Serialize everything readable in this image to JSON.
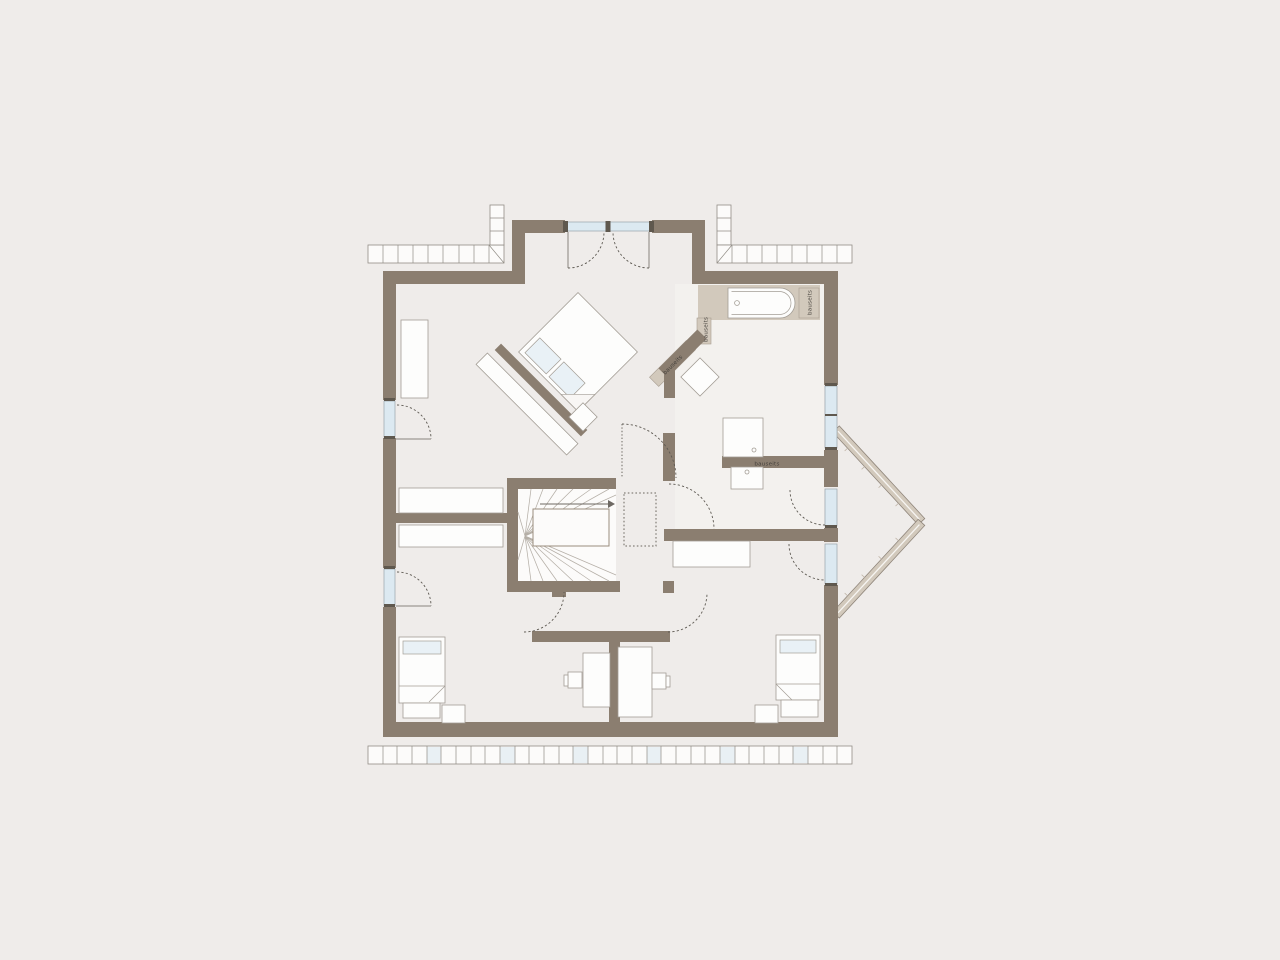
{
  "floorplan": {
    "labels": {
      "tub_left": "bauseits",
      "tub_right": "bauseits",
      "diagonal_wall": "bauseits",
      "basin_wall": "bauseits"
    },
    "colors": {
      "background": "#efecea",
      "wall": "#8b7e70",
      "accent_beige": "#d2c9bc",
      "window_glass": "#dce9f1",
      "furniture_fill": "#fdfdfc",
      "furniture_outline": "#a39d95",
      "bath_floor": "#f3f1ee",
      "door_arc": "#5d5952",
      "hatch_line": "#918c85",
      "pillow_tint": "#e9f1f6"
    }
  }
}
